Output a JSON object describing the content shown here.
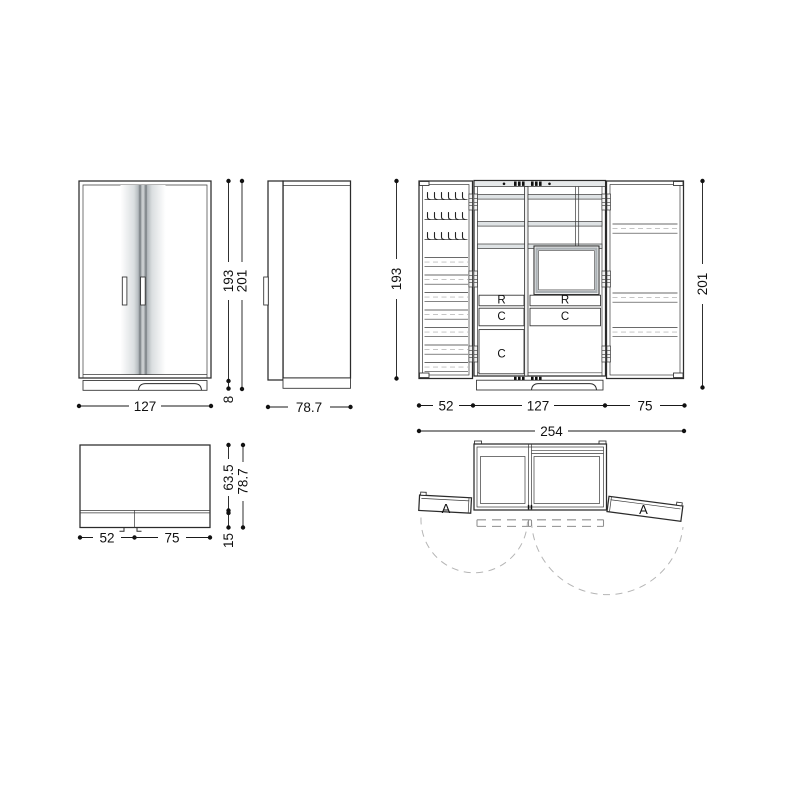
{
  "drawing": {
    "front_view": {
      "width": "127",
      "body_height": "193",
      "total_height": "201",
      "plinth_height": "8"
    },
    "side_view": {
      "depth": "78.7"
    },
    "open_view": {
      "body_height": "193",
      "total_height": "201",
      "left_door_width": "52",
      "center_width": "127",
      "right_door_width": "75",
      "total_width": "254",
      "rail_label": "R",
      "container_label": "C"
    },
    "top_view_closed": {
      "left_door_width": "52",
      "right_door_width": "75",
      "body_depth": "63.5",
      "total_depth": "78.7",
      "door_depth": "15"
    },
    "top_view_open": {
      "door_label": "A"
    }
  }
}
